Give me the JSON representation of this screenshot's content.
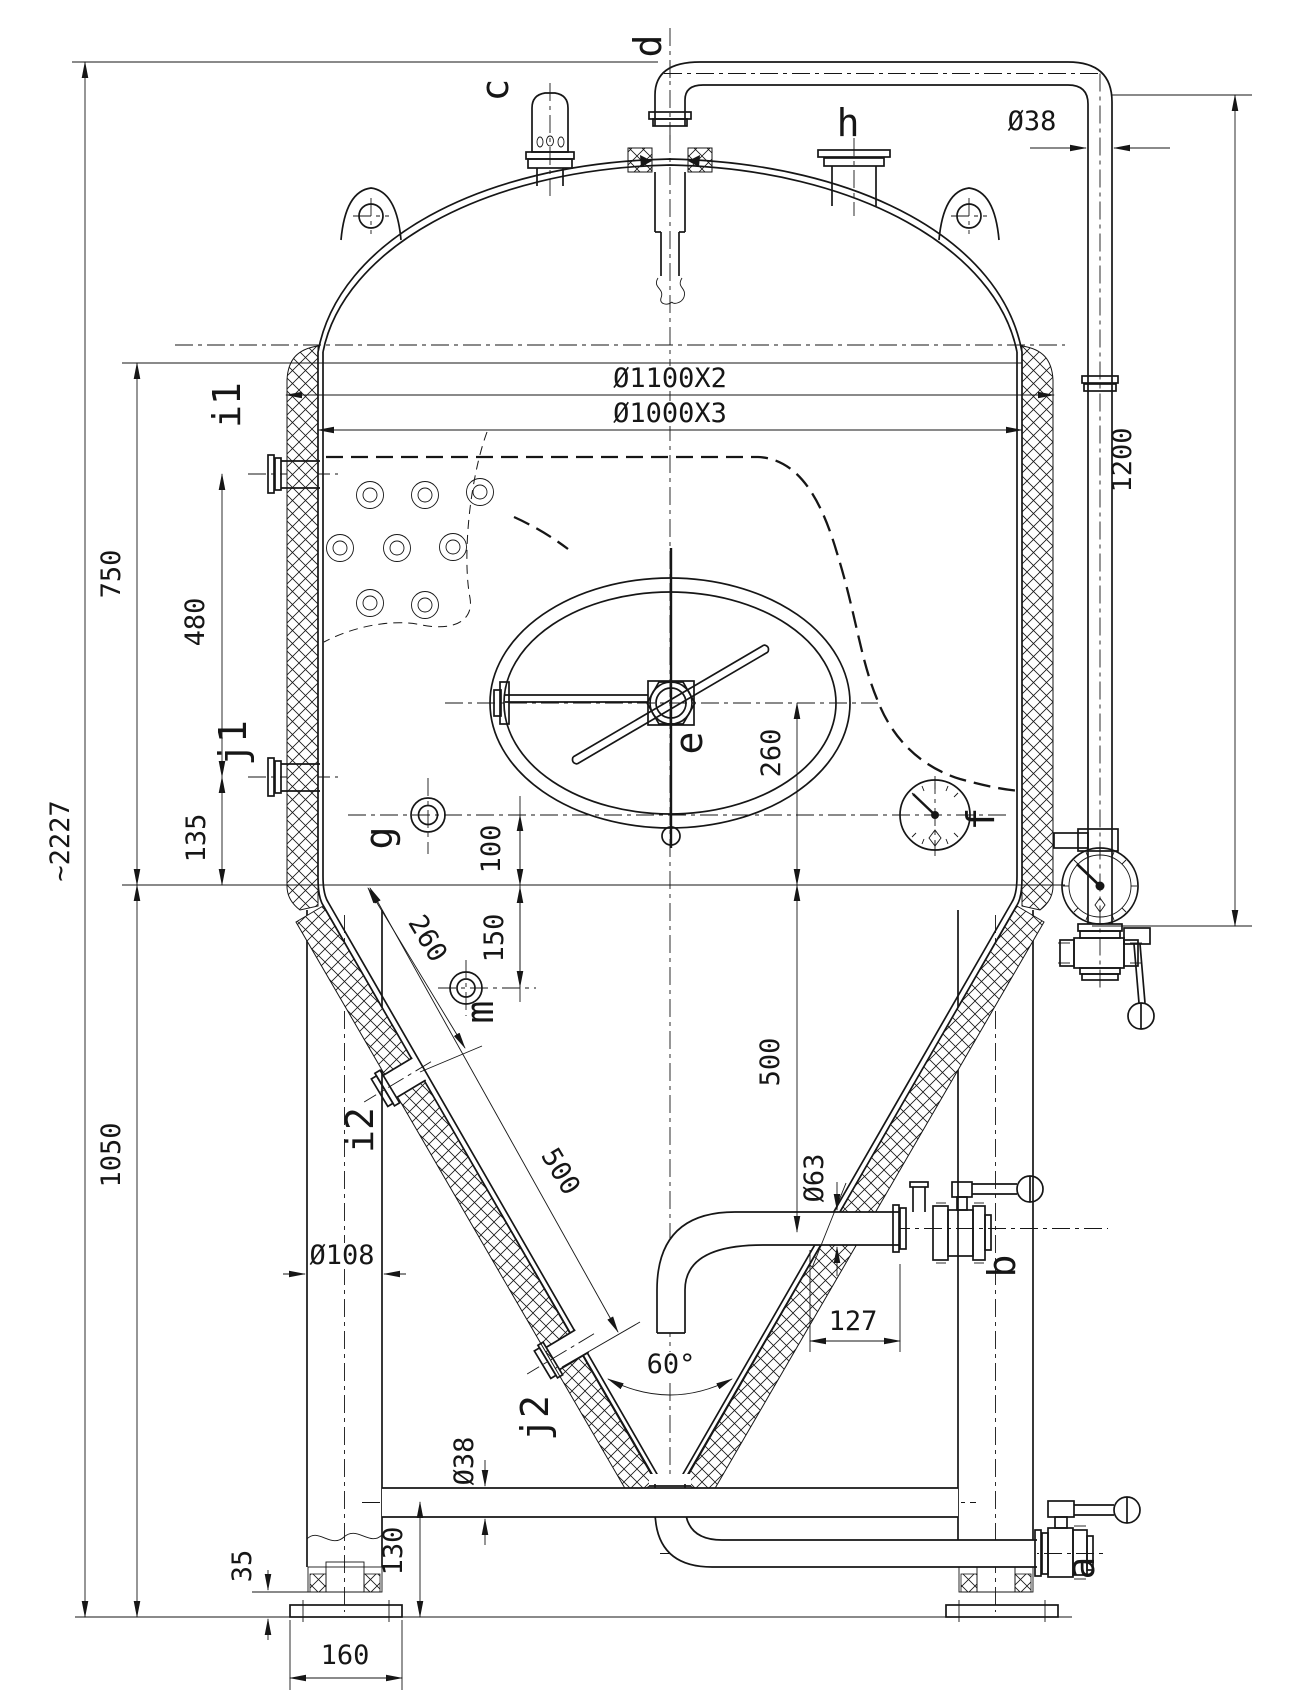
{
  "drawing": {
    "kind": "engineering-drawing",
    "subject": "conical fermenter vessel - dimensioned front elevation",
    "style": {
      "line_color": "#161616",
      "background": "#ffffff"
    },
    "ports": {
      "c": "c",
      "d": "d",
      "h": "h",
      "e": "e",
      "f": "f",
      "g": "g",
      "m": "m",
      "b": "b",
      "a": "a",
      "i1": "i1",
      "j1": "j1",
      "i2": "i2",
      "j2": "j2"
    },
    "dimensions": {
      "shell_od": "Ø1100X2",
      "shell_id": "Ø1000X3",
      "total_height": "~2227",
      "upper_section": "750",
      "side_ports_spacing": "480",
      "j1_to_cone": "135",
      "legs_height": "1050",
      "cip_drop_height": "1200",
      "cip_pipe_dia": "Ø38",
      "manway_center_to_cone": "260",
      "g_to_cone": "100",
      "cone_to_m": "150",
      "cone_dim_260": "260",
      "cone_dim_500": "500",
      "cone_to_racking": "500",
      "leg_dia": "Ø108",
      "racking_dia": "Ø63",
      "racking_offset": "127",
      "cone_angle": "60°",
      "brace_pipe_dia": "Ø38",
      "brace_height": "130",
      "foot_adjust": "35",
      "foot_plate": "160"
    }
  }
}
